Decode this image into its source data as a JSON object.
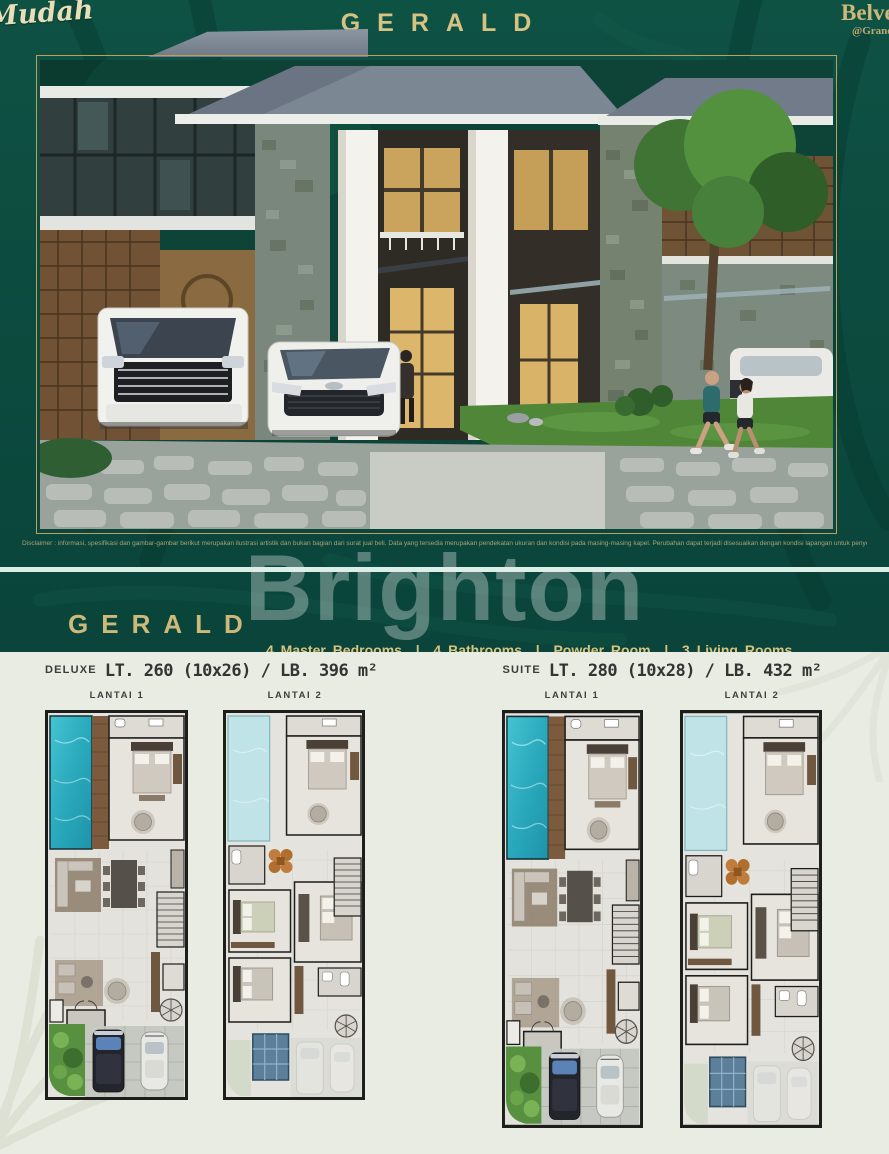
{
  "colors": {
    "banner_green": "#0c4a3e",
    "accent_gold": "#cdb97a",
    "feature_gold": "#d9c57f",
    "pool_turquoise": "#2fb5c5",
    "divider_mint": "#dcefe6",
    "plans_background": "#e9ece2"
  },
  "header": {
    "script_logo": "Mudah",
    "title": "GERALD",
    "brand_line1": "Belvedere",
    "brand_line2": "@Grand",
    "disclaimer": "Disclaimer :  informasi, spesifikasi dan gambar-gambar berikut merupakan ilustrasi artistik dan bukan bagian dari surat jual beli. Data yang tersedia merupakan pendekatan ukuran dan kondisi pada masing-masing kapel. Perubahan dapat terjadi disesuaikan dengan kondisi lapangan untuk penyempurnaan dan merupakan hak penuh developer."
  },
  "watermark": "Brighton",
  "features": {
    "title": "GERALD",
    "line1": "4 Master Bedrooms  |  4 Bathrooms  |  Powder Room  |  3 Living Rooms",
    "line2": "Dining Room  |  Kitchen & Pantry  |  Maidroom  |  Private Pool  |  2 Carports"
  },
  "plans": {
    "deluxe": {
      "name": "DELUXE",
      "spec": "LT. 260 (10x26) / LB. 396 m²",
      "floor1": "LANTAI 1",
      "floor2": "LANTAI 2"
    },
    "suite": {
      "name": "SUITE",
      "spec": "LT. 280 (10x28) / LB. 432 m²",
      "floor1": "LANTAI 1",
      "floor2": "LANTAI 2"
    }
  }
}
